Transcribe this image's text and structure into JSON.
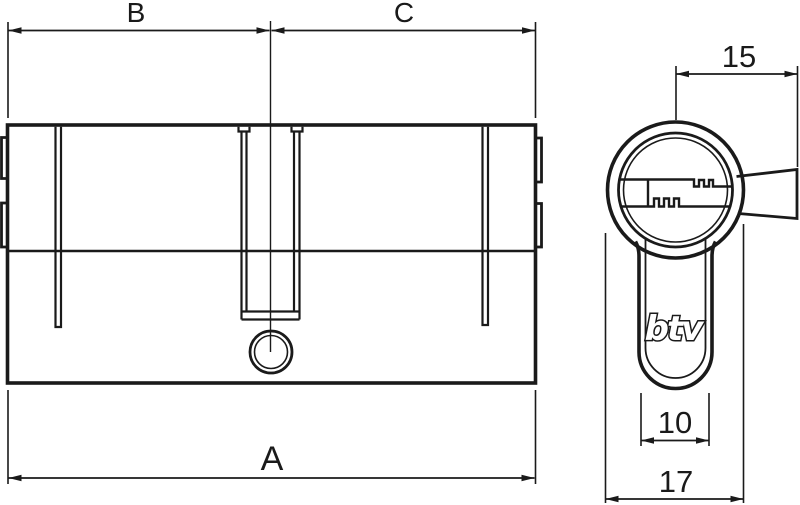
{
  "colors": {
    "line": "#1a1a1a",
    "background": "#ffffff"
  },
  "side_view": {
    "dim_left_half": "B",
    "dim_right_half": "C",
    "dim_total_length": "A"
  },
  "end_view": {
    "logo": "btv",
    "dim_cam_projection": "15",
    "dim_stem_width": "10",
    "dim_body_diameter": "17"
  }
}
